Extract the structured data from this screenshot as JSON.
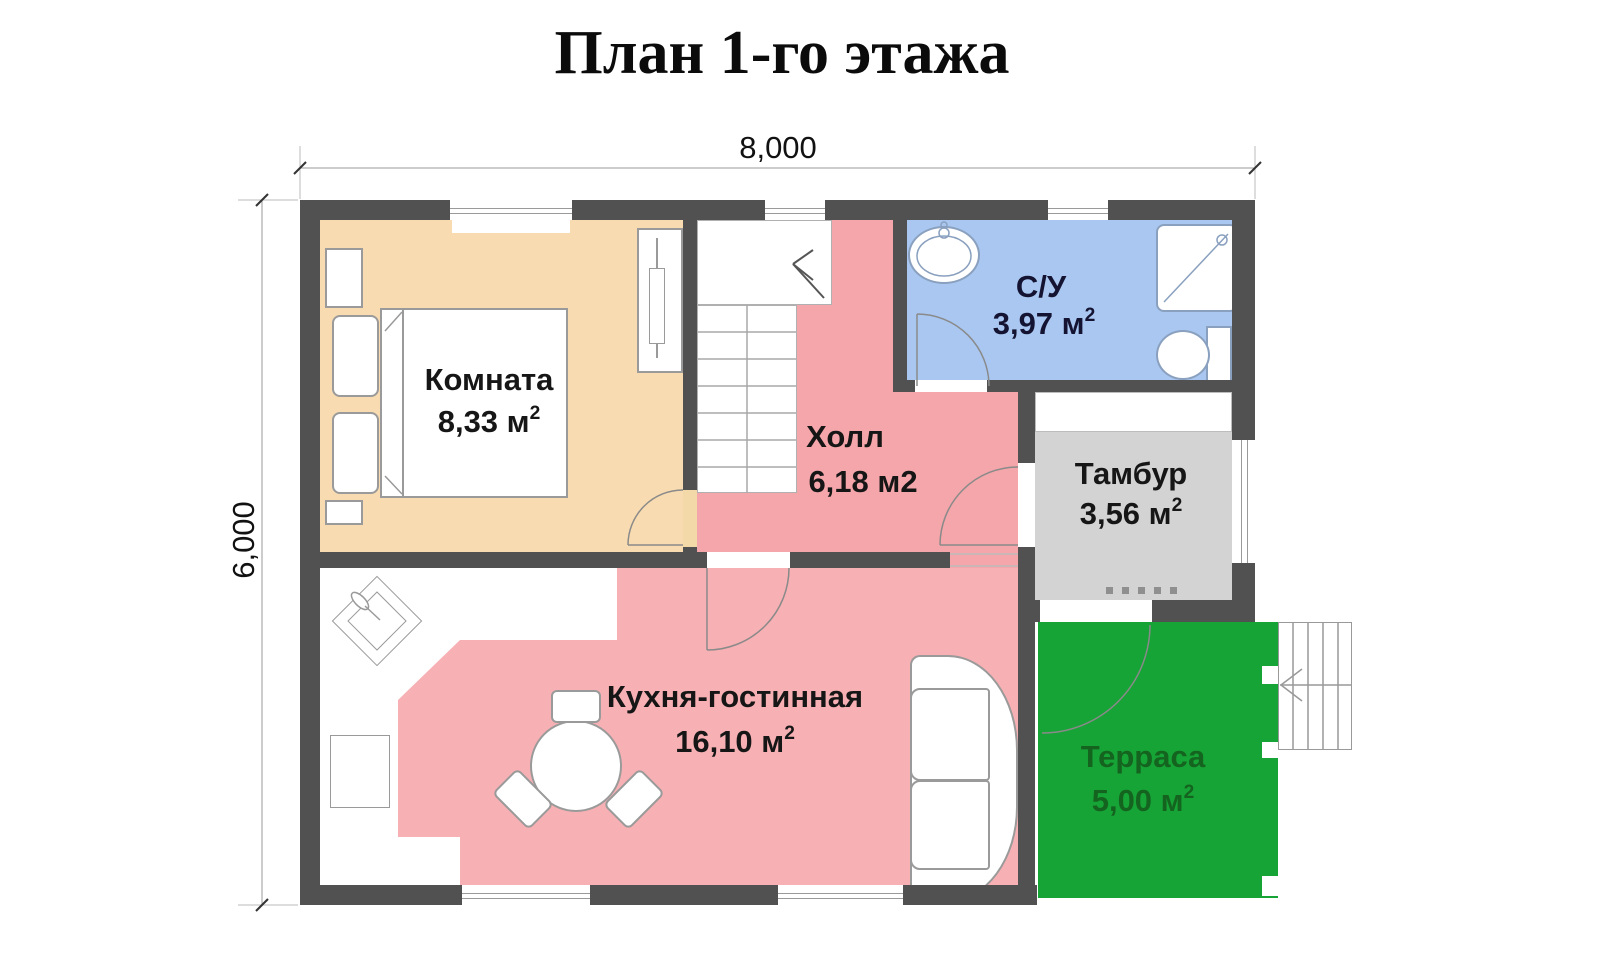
{
  "title": "План 1-го этажа",
  "dimensions": {
    "width": "8,000",
    "height": "6,000"
  },
  "rooms": {
    "bedroom": {
      "name": "Комната",
      "area": "8,33 м",
      "sup": "2"
    },
    "bathroom": {
      "name": "С/У",
      "area": "3,97 м",
      "sup": "2"
    },
    "hall": {
      "name": "Холл",
      "area": "6,18 м2",
      "sup": ""
    },
    "tambour": {
      "name": "Тамбур",
      "area": "3,56 м",
      "sup": "2"
    },
    "kitchen": {
      "name": "Кухня-гостинная",
      "area": "16,10 м",
      "sup": "2"
    },
    "terrace": {
      "name": "Терраса",
      "area": "5,00 м",
      "sup": "2"
    }
  },
  "colors": {
    "wall": "#515151",
    "bedroom": "#f8dbb0",
    "hall": "#f4a6aa",
    "kitchen": "#f7b0b3",
    "bathroom": "#a9c7f0",
    "tambour": "#d3d3d3",
    "terrace": "#17a437",
    "terrace_text": "#14641f",
    "bathroom_text": "#141432"
  }
}
